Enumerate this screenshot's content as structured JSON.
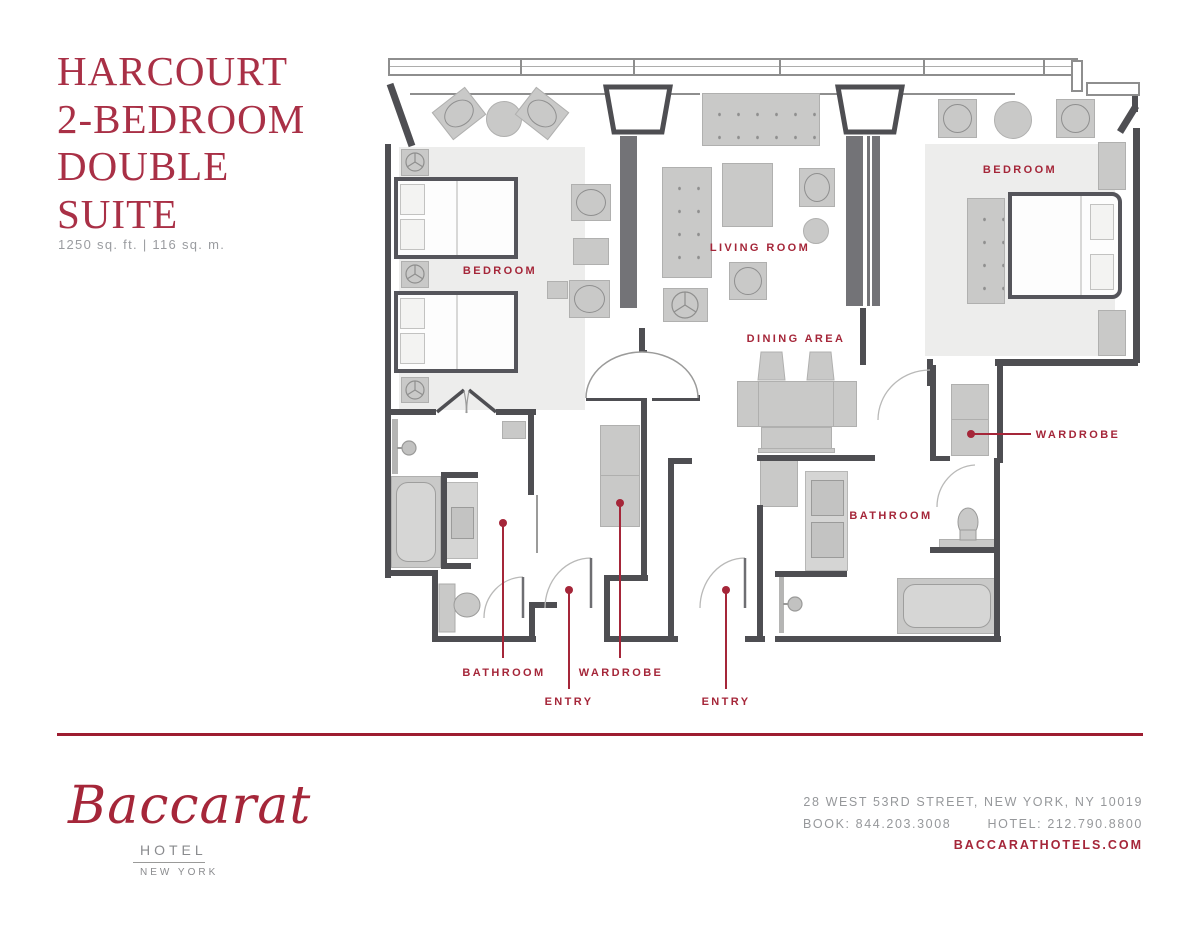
{
  "header": {
    "title_lines": [
      "HARCOURT",
      "2-BEDROOM",
      "DOUBLE",
      "SUITE"
    ],
    "area": "1250 sq. ft. | 116 sq. m."
  },
  "plan": {
    "labels": {
      "bedroom_left": "BEDROOM",
      "living_room": "LIVING ROOM",
      "dining_area": "DINING AREA",
      "bedroom_right": "BEDROOM",
      "wardrobe_right": "WARDROBE",
      "bathroom_right": "BATHROOM",
      "bathroom_left": "BATHROOM",
      "entry_left": "ENTRY",
      "wardrobe_center": "WARDROBE",
      "entry_right": "ENTRY"
    }
  },
  "footer": {
    "logo": {
      "brand": "Baccarat",
      "type": "HOTEL",
      "city": "NEW YORK"
    },
    "address": "28 WEST 53RD STREET, NEW YORK, NY 10019",
    "book_label": "BOOK: 844.203.3008",
    "hotel_label": "HOTEL: 212.790.8800",
    "website": "BACCARATHOTELS.COM"
  },
  "colors": {
    "accent_red": "#A52639",
    "wall_gray": "#4E4E52",
    "furniture_gray": "#C9C9C8",
    "text_gray": "#96989B"
  }
}
